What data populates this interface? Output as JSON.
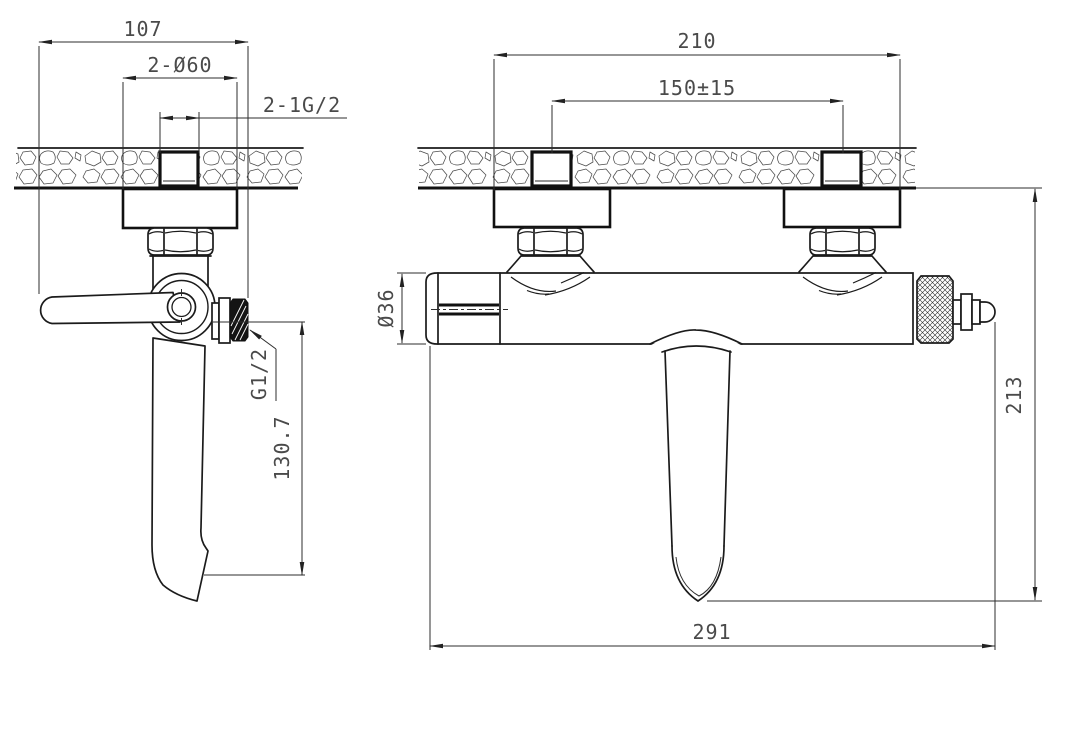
{
  "drawing": {
    "kind": "bath-mixer-faucet-installation-drawing",
    "views": {
      "side_view": {
        "dims": {
          "overall_projection": "107",
          "escutcheon_diameter": "2-Ø60",
          "inlet_thread": "2-1G/2",
          "outlet_thread": "G1/2",
          "spout_drop_height": "130.7"
        }
      },
      "front_view": {
        "dims": {
          "escutcheon_span": "210",
          "inlet_spacing": "150±15",
          "body_diameter": "Ø36",
          "overall_height": "213",
          "overall_length": "291"
        }
      }
    },
    "colors": {
      "background": "#ffffff",
      "object_line": "#1b1b1b",
      "dimension_line": "#2e2e2e",
      "dimension_text": "#4a4a4a"
    }
  }
}
